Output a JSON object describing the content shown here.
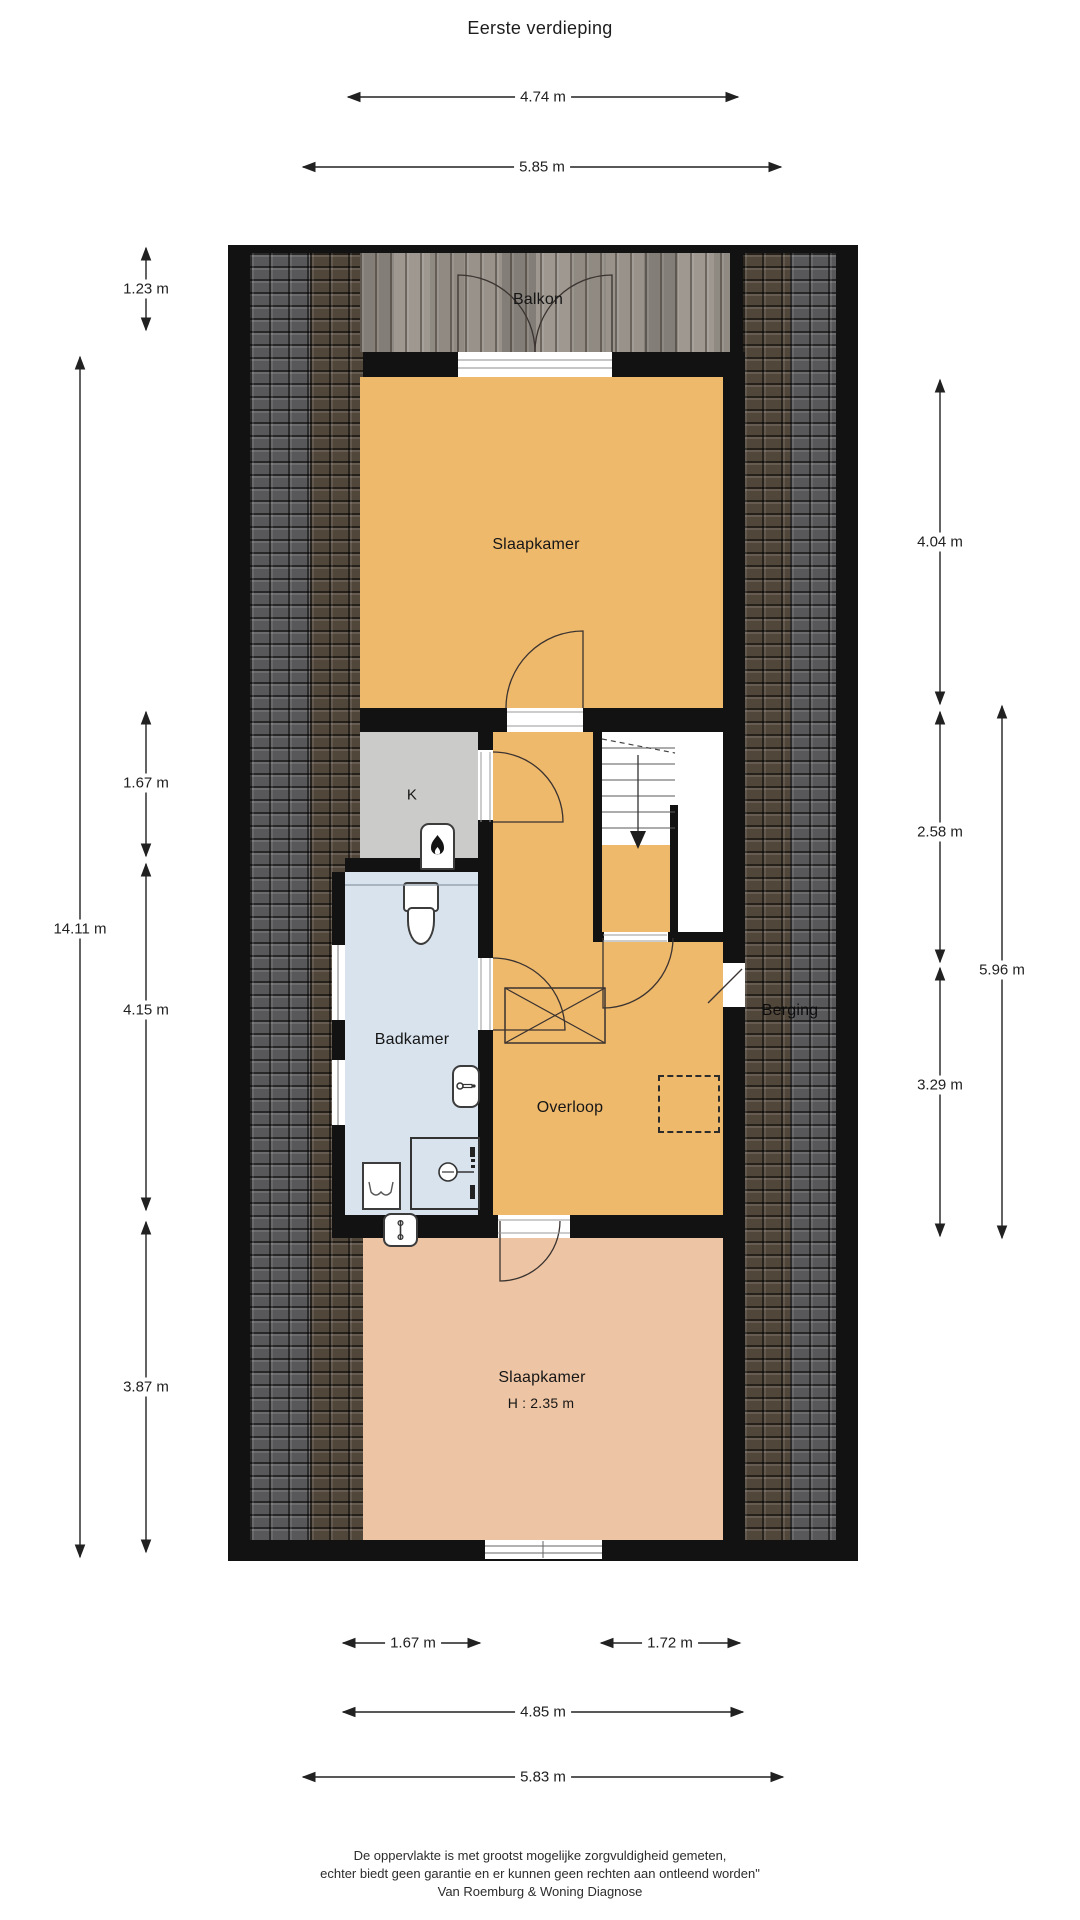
{
  "title": "Eerste verdieping",
  "floor_plan": {
    "rooms": {
      "balkon": {
        "label": "Balkon"
      },
      "slaapkamer_top": {
        "label": "Slaapkamer"
      },
      "kast": {
        "label": "K"
      },
      "badkamer": {
        "label": "Badkamer"
      },
      "overloop": {
        "label": "Overloop"
      },
      "berging": {
        "label": "Berging"
      },
      "slaapkamer_bottom": {
        "label": "Slaapkamer",
        "height_note": "H : 2.35 m"
      }
    },
    "icons": [
      "stove-icon",
      "toilet-icon",
      "sink-icon",
      "shower-icon",
      "washer-icon",
      "radiator-icon",
      "skylight-icon",
      "hatch-icon",
      "stairs-down-arrow-icon"
    ],
    "colors": {
      "room_orange": "#efb96c",
      "room_salmon": "#eec5a4",
      "room_blue": "#d8e3ee",
      "room_gray": "#cbcbc9",
      "wall": "#121212",
      "wood_deck": "#98928a",
      "tile_gray": "#58585a",
      "tile_brown": "#51463a"
    }
  },
  "dimensions": {
    "top": [
      {
        "label": "4.74 m"
      },
      {
        "label": "5.85 m"
      }
    ],
    "left": [
      {
        "label": "1.23 m"
      },
      {
        "label": "14.11 m"
      },
      {
        "label": "1.67 m"
      },
      {
        "label": "4.15 m"
      },
      {
        "label": "3.87 m"
      }
    ],
    "right": [
      {
        "label": "4.04 m"
      },
      {
        "label": "2.58 m"
      },
      {
        "label": "5.96 m"
      },
      {
        "label": "3.29 m"
      }
    ],
    "bottom": [
      {
        "label": "1.67 m"
      },
      {
        "label": "1.72 m"
      },
      {
        "label": "4.85 m"
      },
      {
        "label": "5.83 m"
      }
    ]
  },
  "footer": {
    "line1": "De oppervlakte is met grootst mogelijke zorgvuldigheid gemeten,",
    "line2": "echter biedt geen garantie en er kunnen geen rechten aan ontleend worden\"",
    "line3": "Van Roemburg & Woning Diagnose"
  }
}
